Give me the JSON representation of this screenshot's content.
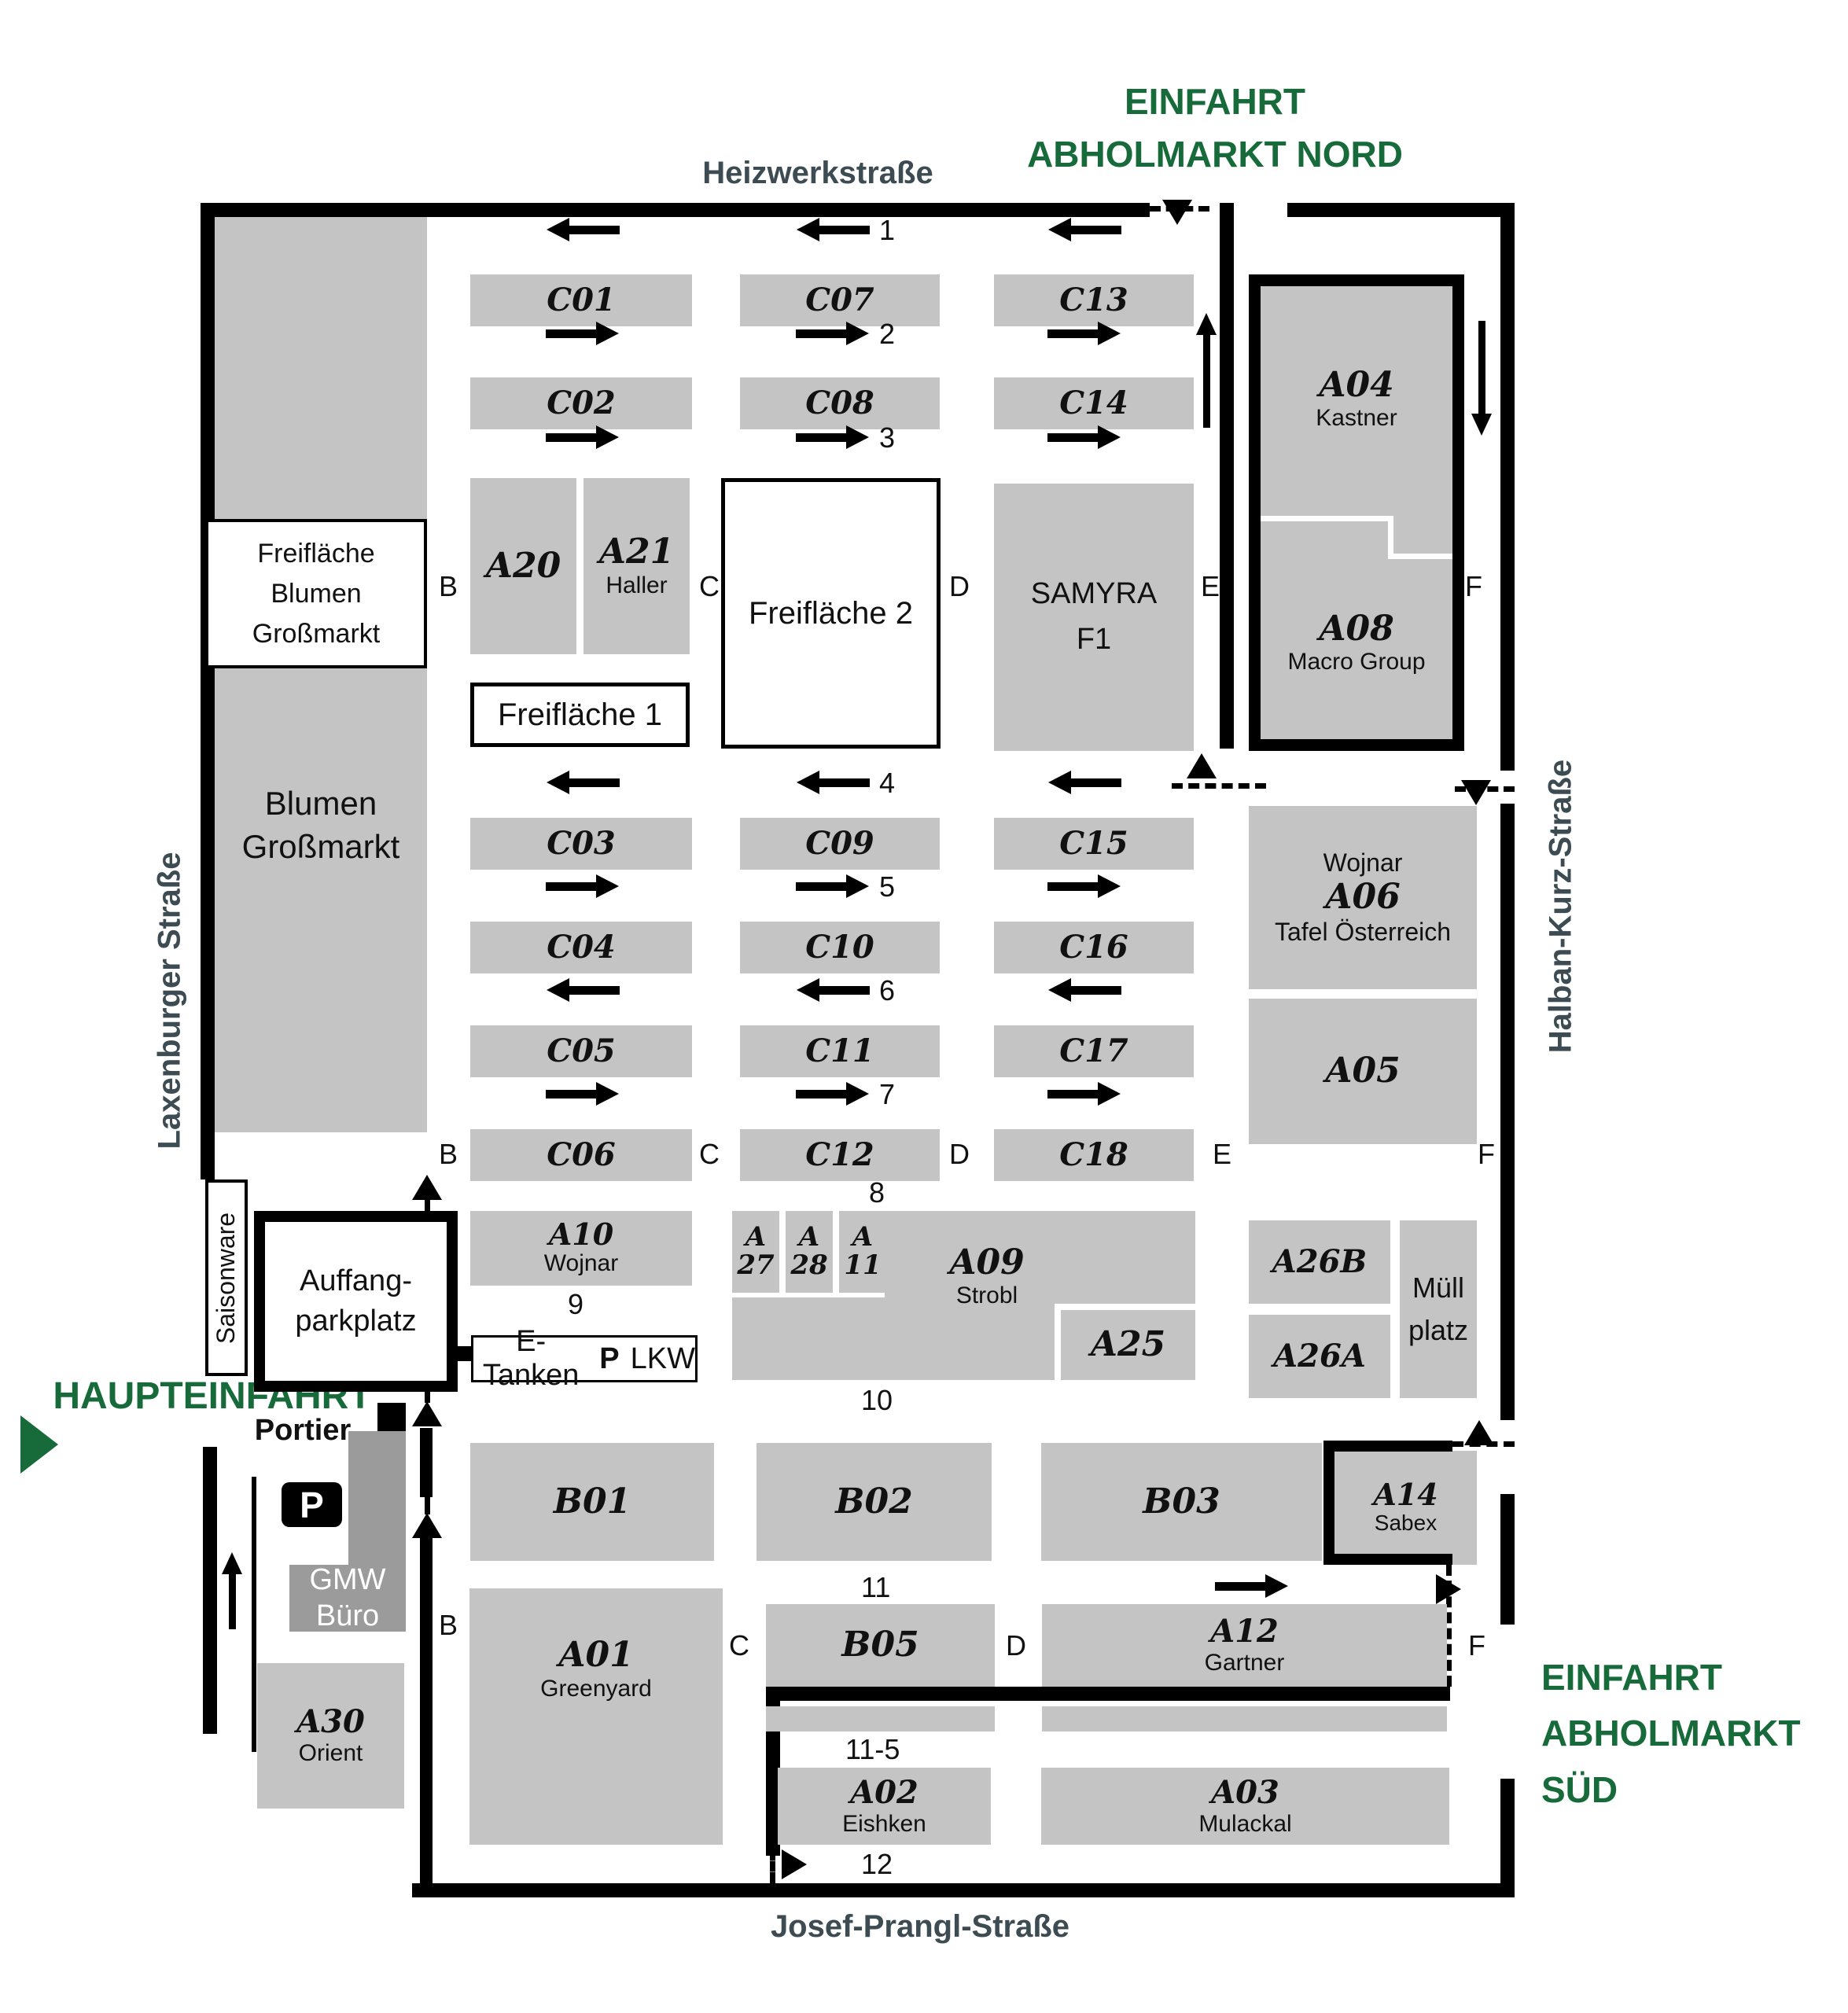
{
  "colors": {
    "block_gray": "#c4c4c4",
    "dark_gray": "#9b9b9b",
    "accent_green": "#176b3a",
    "street_text": "#3d4b52",
    "line_black": "#000000"
  },
  "streets": {
    "top": "Heizwerkstraße",
    "left": "Laxenburger Straße",
    "right": "Halban-Kurz-Straße",
    "bottom": "Josef-Prangl-Straße"
  },
  "entrances": {
    "north": {
      "line1": "EINFAHRT",
      "line2": "ABHOLMARKT NORD"
    },
    "main": {
      "label": "HAUPTEINFAHRT",
      "gatehouse": "Portier"
    },
    "south": {
      "line1": "EINFAHRT",
      "line2": "ABHOLMARKT",
      "line3": "SÜD"
    }
  },
  "lanes": {
    "l1": "1",
    "l2": "2",
    "l3": "3",
    "l4": "4",
    "l5": "5",
    "l6": "6",
    "l7": "7",
    "l8": "8",
    "l9": "9",
    "l10": "10",
    "l11": "11",
    "l11_5": "11-5",
    "l12": "12"
  },
  "letters": {
    "b": "B",
    "c": "C",
    "d": "D",
    "e": "E",
    "f": "F"
  },
  "blocks": {
    "c01": {
      "id": "C01"
    },
    "c02": {
      "id": "C02"
    },
    "c03": {
      "id": "C03"
    },
    "c04": {
      "id": "C04"
    },
    "c05": {
      "id": "C05"
    },
    "c06": {
      "id": "C06"
    },
    "c07": {
      "id": "C07"
    },
    "c08": {
      "id": "C08"
    },
    "c09": {
      "id": "C09"
    },
    "c10": {
      "id": "C10"
    },
    "c11": {
      "id": "C11"
    },
    "c12": {
      "id": "C12"
    },
    "c13": {
      "id": "C13"
    },
    "c14": {
      "id": "C14"
    },
    "c15": {
      "id": "C15"
    },
    "c16": {
      "id": "C16"
    },
    "c17": {
      "id": "C17"
    },
    "c18": {
      "id": "C18"
    },
    "a20": {
      "id": "A20"
    },
    "a21": {
      "id": "A21",
      "tenant": "Haller"
    },
    "a04": {
      "id": "A04",
      "tenant": "Kastner"
    },
    "a08": {
      "id": "A08",
      "tenant": "Macro Group"
    },
    "samyra": {
      "line1": "SAMYRA",
      "line2": "F1"
    },
    "a06": {
      "owner": "Wojnar",
      "id": "A06",
      "tenant": "Tafel Österreich"
    },
    "a05": {
      "id": "A05"
    },
    "a10": {
      "id": "A10",
      "tenant": "Wojnar"
    },
    "a27": {
      "line1": "A",
      "line2": "27"
    },
    "a28": {
      "line1": "A",
      "line2": "28"
    },
    "a11": {
      "line1": "A",
      "line2": "11"
    },
    "a09": {
      "id": "A09",
      "tenant": "Strobl"
    },
    "a25": {
      "id": "A25"
    },
    "a26b": {
      "id": "A26B"
    },
    "a26a": {
      "id": "A26A"
    },
    "muell": {
      "line1": "Müll",
      "line2": "platz"
    },
    "b01": {
      "id": "B01"
    },
    "b02": {
      "id": "B02"
    },
    "b03": {
      "id": "B03"
    },
    "a14": {
      "id": "A14",
      "tenant": "Sabex"
    },
    "b05": {
      "id": "B05"
    },
    "a12": {
      "id": "A12",
      "tenant": "Gartner"
    },
    "a01": {
      "id": "A01",
      "tenant": "Greenyard"
    },
    "a02": {
      "id": "A02",
      "tenant": "Eishken"
    },
    "a03": {
      "id": "A03",
      "tenant": "Mulackal"
    },
    "a30": {
      "id": "A30",
      "tenant": "Orient"
    },
    "blumen": {
      "line1": "Blumen",
      "line2": "Großmarkt"
    }
  },
  "areas": {
    "freiflaeche1": "Freifläche 1",
    "freiflaeche2": "Freifläche 2",
    "freiflaeche_blumen": {
      "line1": "Freifläche",
      "line2": "Blumen Großmarkt"
    },
    "saisonware": "Saisonware",
    "auffang": {
      "line1": "Auffang-",
      "line2": "parkplatz"
    },
    "gmw": {
      "line1": "GMW",
      "line2": "Büro"
    },
    "etanken": {
      "label": "E-Tanken",
      "p": "P",
      "lkw": "LKW"
    },
    "parking": "P"
  }
}
